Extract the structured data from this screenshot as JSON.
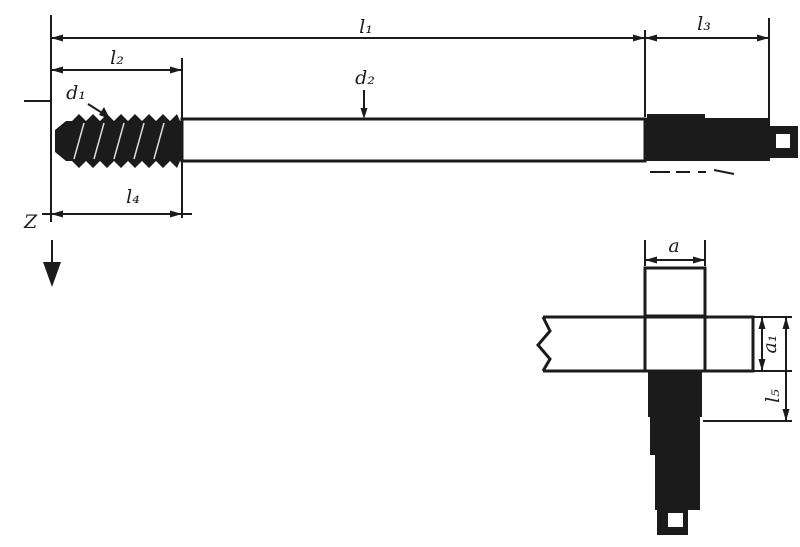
{
  "drawing": {
    "background": "#ffffff",
    "ink": "#1b1b1b",
    "labels": {
      "overall_length": "l₁",
      "thread_length": "l₂",
      "square_length": "l₃",
      "front_length": "l₄",
      "thread_diameter": "d₁",
      "shank_diameter": "d₂",
      "square_width": "a",
      "detail_side": "a₁",
      "detail_length": "l₅",
      "view_arrow": "Z"
    }
  }
}
